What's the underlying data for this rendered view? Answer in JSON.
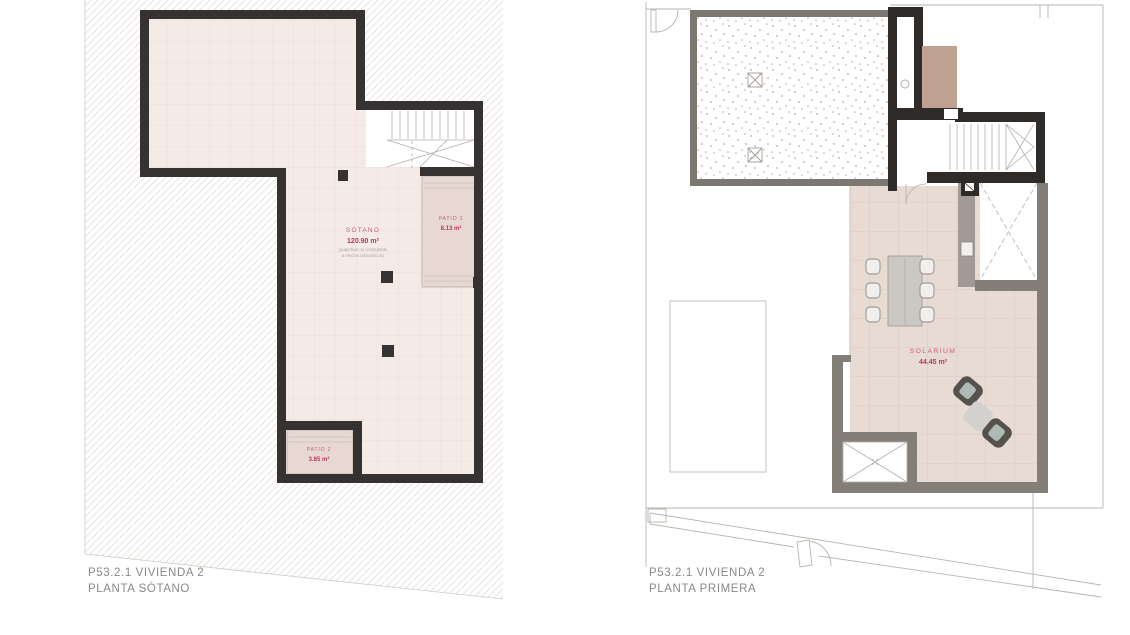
{
  "document": {
    "type": "architectural floor plan sheet",
    "sheet_background": "#ffffff"
  },
  "colors": {
    "wall_dark": "#353231",
    "wall_gray": "#7d7772",
    "wall_gray_light": "#a19b95",
    "floor_basement": "#f4eae6",
    "floor_grid": "#e9dcd7",
    "floor_solarium": "#e8dbd4",
    "solarium_grid": "#dbcac3",
    "patio_fill": "#e7d9d2",
    "hatch_line": "#e6e2de",
    "boundary_line": "#b9b4af",
    "accent_label": "#cf5d77",
    "accent_value": "#bf3558",
    "note_text": "#b3a5a3",
    "title_text": "#8b8987",
    "tan_block": "#bfa191",
    "lounge_dark": "#55524e",
    "lounge_seat": "#aebab6",
    "side_table": "#d3d1ce"
  },
  "plans": {
    "left": {
      "title_line1": "P53.2.1 VIVIENDA 2",
      "title_line2": "PLANTA SÓTANO",
      "rooms": {
        "sotano": {
          "name": "SÓTANO",
          "area": "120.90 m²",
          "note_line1": "(superficie no computable",
          "note_line2": "a efectos urbanísticos)"
        },
        "patio1": {
          "name": "PATIO 1",
          "area": "8.13 m²"
        },
        "patio2": {
          "name": "PATIO 2",
          "area": "3.85 m²"
        }
      }
    },
    "right": {
      "title_line1": "P53.2.1 VIVIENDA 2",
      "title_line2": "PLANTA PRIMERA",
      "rooms": {
        "solarium": {
          "name": "SOLARIUM",
          "area": "44.45 m²"
        }
      }
    }
  }
}
